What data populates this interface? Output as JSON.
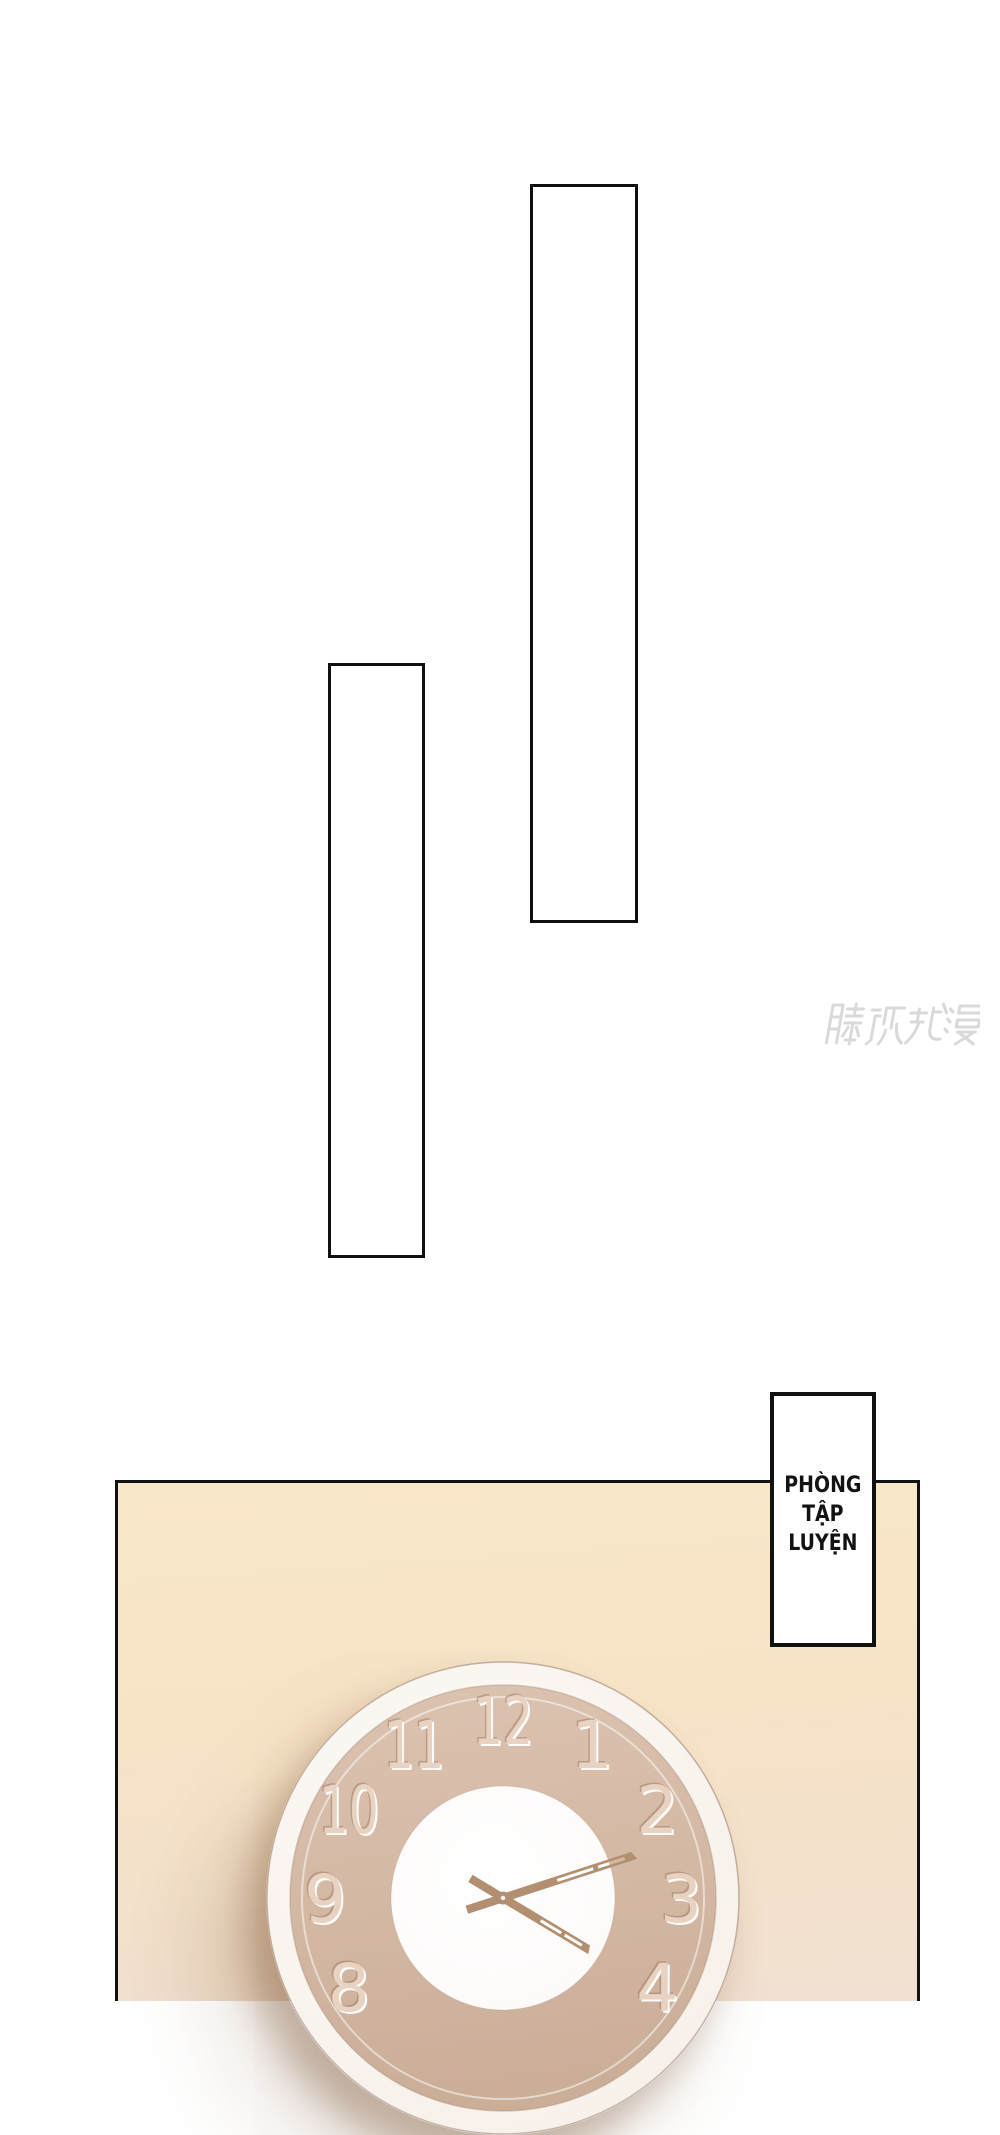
{
  "comic": {
    "watermark": {
      "text": "腾讯动漫",
      "title": "Tencent Comics watermark",
      "color": "#d9d9d9"
    },
    "sign": {
      "lines": [
        "PHÒNG",
        "TẬP",
        "LUYỆN"
      ]
    },
    "clock": {
      "numerals": [
        12,
        1,
        2,
        3,
        4,
        8,
        9,
        10,
        11
      ],
      "minute_hand_deg": 72,
      "hour_hand_deg": 121,
      "colors": {
        "rim": "#f8f2ec",
        "face_top": "#dcc3b1",
        "face_bottom": "#cbae98",
        "inner_circle": "#ffffff",
        "hands": "#b2906f",
        "numeral": "#e8d3c3",
        "numeral_shade": "rgba(150,112,88,0.45)",
        "numeral_highlight": "rgba(255,255,255,0.95)"
      }
    },
    "colors": {
      "page_bg": "#ffffff",
      "panel_bg": "#f8e6c8",
      "line": "#111111"
    }
  }
}
